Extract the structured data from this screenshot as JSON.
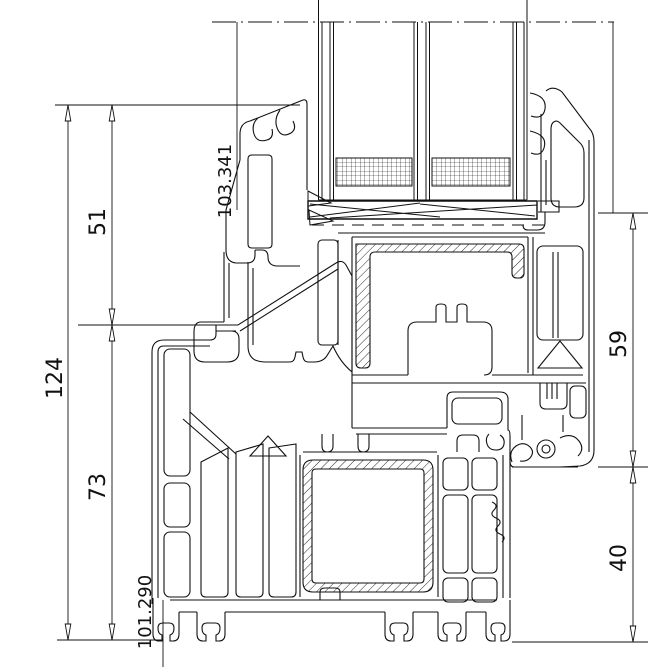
{
  "drawing": {
    "title": "window-profile-cross-section",
    "background_color": "#ffffff",
    "line_color": "#111111",
    "labels": {
      "dim_total_height": "124",
      "dim_upper_left": "51",
      "dim_lower_left": "73",
      "dim_right_upper": "59",
      "dim_right_lower": "40",
      "coord_top": "103.341",
      "coord_bottom": "101.290"
    },
    "dimensions": [
      {
        "name": "total-height-left",
        "value": "124",
        "orientation": "vertical"
      },
      {
        "name": "upper-segment-left",
        "value": "51",
        "orientation": "vertical"
      },
      {
        "name": "lower-segment-left",
        "value": "73",
        "orientation": "vertical"
      },
      {
        "name": "upper-segment-right",
        "value": "59",
        "orientation": "vertical"
      },
      {
        "name": "lower-segment-right",
        "value": "40",
        "orientation": "vertical"
      },
      {
        "name": "reference-coordinate-top",
        "value": "103.341"
      },
      {
        "name": "reference-coordinate-bottom",
        "value": "101.290"
      }
    ]
  }
}
